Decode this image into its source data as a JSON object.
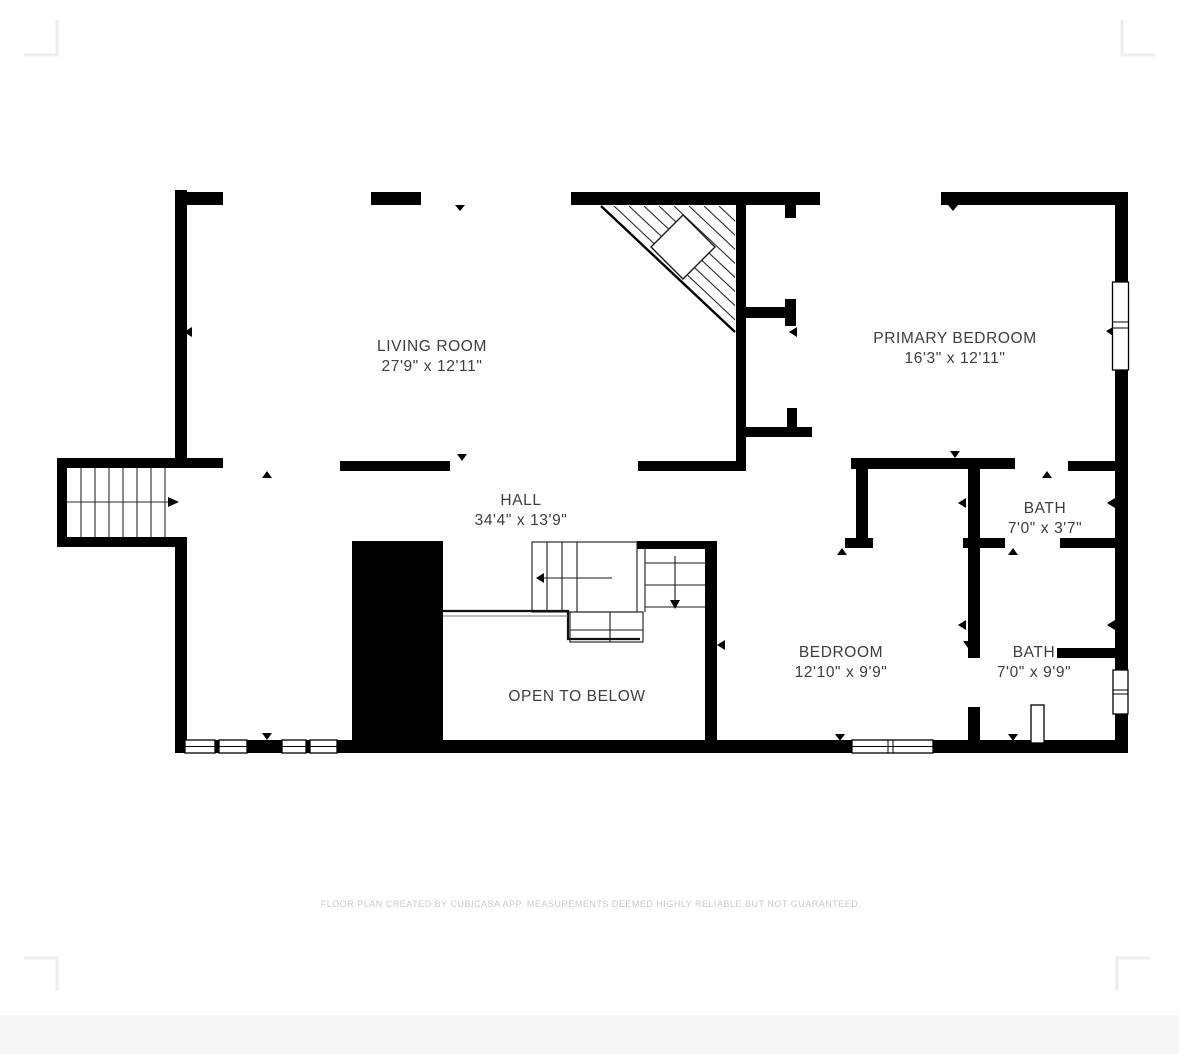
{
  "plan": {
    "rooms": {
      "living_room": {
        "name": "LIVING ROOM",
        "dimensions": "27'9\" x 12'11\""
      },
      "primary_bedroom": {
        "name": "PRIMARY BEDROOM",
        "dimensions": "16'3\" x 12'11\""
      },
      "hall": {
        "name": "HALL",
        "dimensions": "34'4\" x 13'9\""
      },
      "bedroom": {
        "name": "BEDROOM",
        "dimensions": "12'10\" x 9'9\""
      },
      "bath_small": {
        "name": "BATH",
        "dimensions": "7'0\" x 3'7\""
      },
      "bath_large": {
        "name": "BATH",
        "dimensions": "7'0\" x 9'9\""
      },
      "open_to_below": {
        "name": "OPEN TO BELOW"
      }
    },
    "footer": {
      "disclaimer": "FLOOR PLAN CREATED BY CUBICASA APP. MEASUREMENTS DEEMED HIGHLY RELIABLE BUT NOT GUARANTEED."
    },
    "colors": {
      "wall": "#000000",
      "room_text": "#3d3d3d",
      "disclaimer_text": "#c9c9c9",
      "page_background": "#ffffff",
      "bottom_band": "#f5f5f5",
      "crop_marks": "#ededed"
    }
  }
}
